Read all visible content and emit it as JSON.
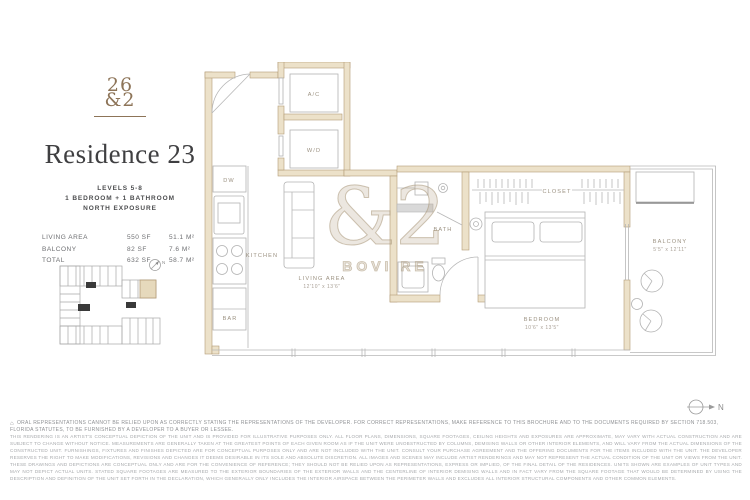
{
  "brand": {
    "logo_line1": "26",
    "logo_line2": "&2"
  },
  "title": "Residence 23",
  "unit_info": {
    "levels": "LEVELS 5-8",
    "config": "1 BEDROOM + 1 BATHROOM",
    "exposure": "NORTH EXPOSURE"
  },
  "area_table": {
    "rows": [
      {
        "label": "LIVING AREA",
        "sf": "550 SF",
        "m2": "51.1 M²"
      },
      {
        "label": "BALCONY",
        "sf": "82 SF",
        "m2": "7.6 M²"
      },
      {
        "label": "TOTAL",
        "sf": "632 SF",
        "m2": "58.7 M²"
      }
    ]
  },
  "floorplan": {
    "labels": {
      "dw": "DW",
      "kitchen": "KITCHEN",
      "bar": "BAR",
      "ac": "A/C",
      "wd": "W/D",
      "living": "LIVING AREA",
      "living_dim": "12'10\" x 13'6\"",
      "bath": "BATH",
      "closet": "CLOSET",
      "bedroom": "BEDROOM",
      "bedroom_dim": "10'6\" x 13'5\"",
      "balcony": "BALCONY",
      "balcony_dim": "5'5\" x 12'11\""
    }
  },
  "watermark": {
    "glyphs": "&2",
    "text": "BOVI RE"
  },
  "compass": {
    "north": "N"
  },
  "disclaimer": {
    "line1": "ORAL REPRESENTATIONS CANNOT BE RELIED UPON AS CORRECTLY STATING THE REPRESENTATIONS OF THE DEVELOPER. FOR CORRECT REPRESENTATIONS, MAKE REFERENCE TO THIS BROCHURE AND TO THE DOCUMENTS REQUIRED BY SECTION 718.503, FLORIDA STATUTES, TO BE FURNISHED BY A DEVELOPER TO A BUYER OR LESSEE.",
    "body": "THIS RENDERING IS AN ARTIST'S CONCEPTUAL DEPICTION OF THE UNIT AND IS PROVIDED FOR ILLUSTRATIVE PURPOSES ONLY. ALL FLOOR PLANS, DIMENSIONS, SQUARE FOOTAGES, CEILING HEIGHTS AND EXPOSURES ARE APPROXIMATE, MAY VARY WITH ACTUAL CONSTRUCTION AND ARE SUBJECT TO CHANGE WITHOUT NOTICE. MEASUREMENTS ARE GENERALLY TAKEN AT THE GREATEST POINTS OF EACH GIVEN ROOM AS IF THE UNIT WERE UNOBSTRUCTED BY COLUMNS, DEMISING WALLS OR OTHER INTERIOR ELEMENTS, AND WILL VARY FROM THE ACTUAL DIMENSIONS OF THE CONSTRUCTED UNIT. FURNISHINGS, FIXTURES AND FINISHES DEPICTED ARE FOR CONCEPTUAL PURPOSES ONLY AND ARE NOT INCLUDED WITH THE UNIT. CONSULT YOUR PURCHASE AGREEMENT AND THE OFFERING DOCUMENTS FOR THE ITEMS INCLUDED WITH THE UNIT. THE DEVELOPER RESERVES THE RIGHT TO MAKE MODIFICATIONS, REVISIONS AND CHANGES IT DEEMS DESIRABLE IN ITS SOLE AND ABSOLUTE DISCRETION. ALL IMAGES AND SCENES MAY INCLUDE ARTIST RENDERINGS AND MAY NOT REPRESENT THE ACTUAL CONDITION OF THE UNIT OR VIEWS FROM THE UNIT. THESE DRAWINGS AND DEPICTIONS ARE CONCEPTUAL ONLY AND ARE FOR THE CONVENIENCE OF REFERENCE; THEY SHOULD NOT BE RELIED UPON AS REPRESENTATIONS, EXPRESS OR IMPLIED, OF THE FINAL DETAIL OF THE RESIDENCES. UNITS SHOWN ARE EXAMPLES OF UNIT TYPES AND MAY NOT DEPICT ACTUAL UNITS. STATED SQUARE FOOTAGES ARE MEASURED TO THE EXTERIOR BOUNDARIES OF THE EXTERIOR WALLS AND THE CENTERLINE OF INTERIOR DEMISING WALLS AND IN FACT VARY FROM THE SQUARE FOOTAGE THAT WOULD BE DETERMINED BY USING THE DESCRIPTION AND DEFINITION OF THE UNIT SET FORTH IN THE DECLARATION, WHICH GENERALLY ONLY INCLUDES THE INTERIOR AIRSPACE BETWEEN THE PERIMETER WALLS AND EXCLUDES ALL INTERIOR STRUCTURAL COMPONENTS AND OTHER COMMON ELEMENTS."
  },
  "colors": {
    "wall_fill": "#ece1c9",
    "wall_stroke": "#b49c77",
    "accent_brown": "#8d7458",
    "label_gray": "#9b9181",
    "line_gray": "#b7b7b7"
  }
}
